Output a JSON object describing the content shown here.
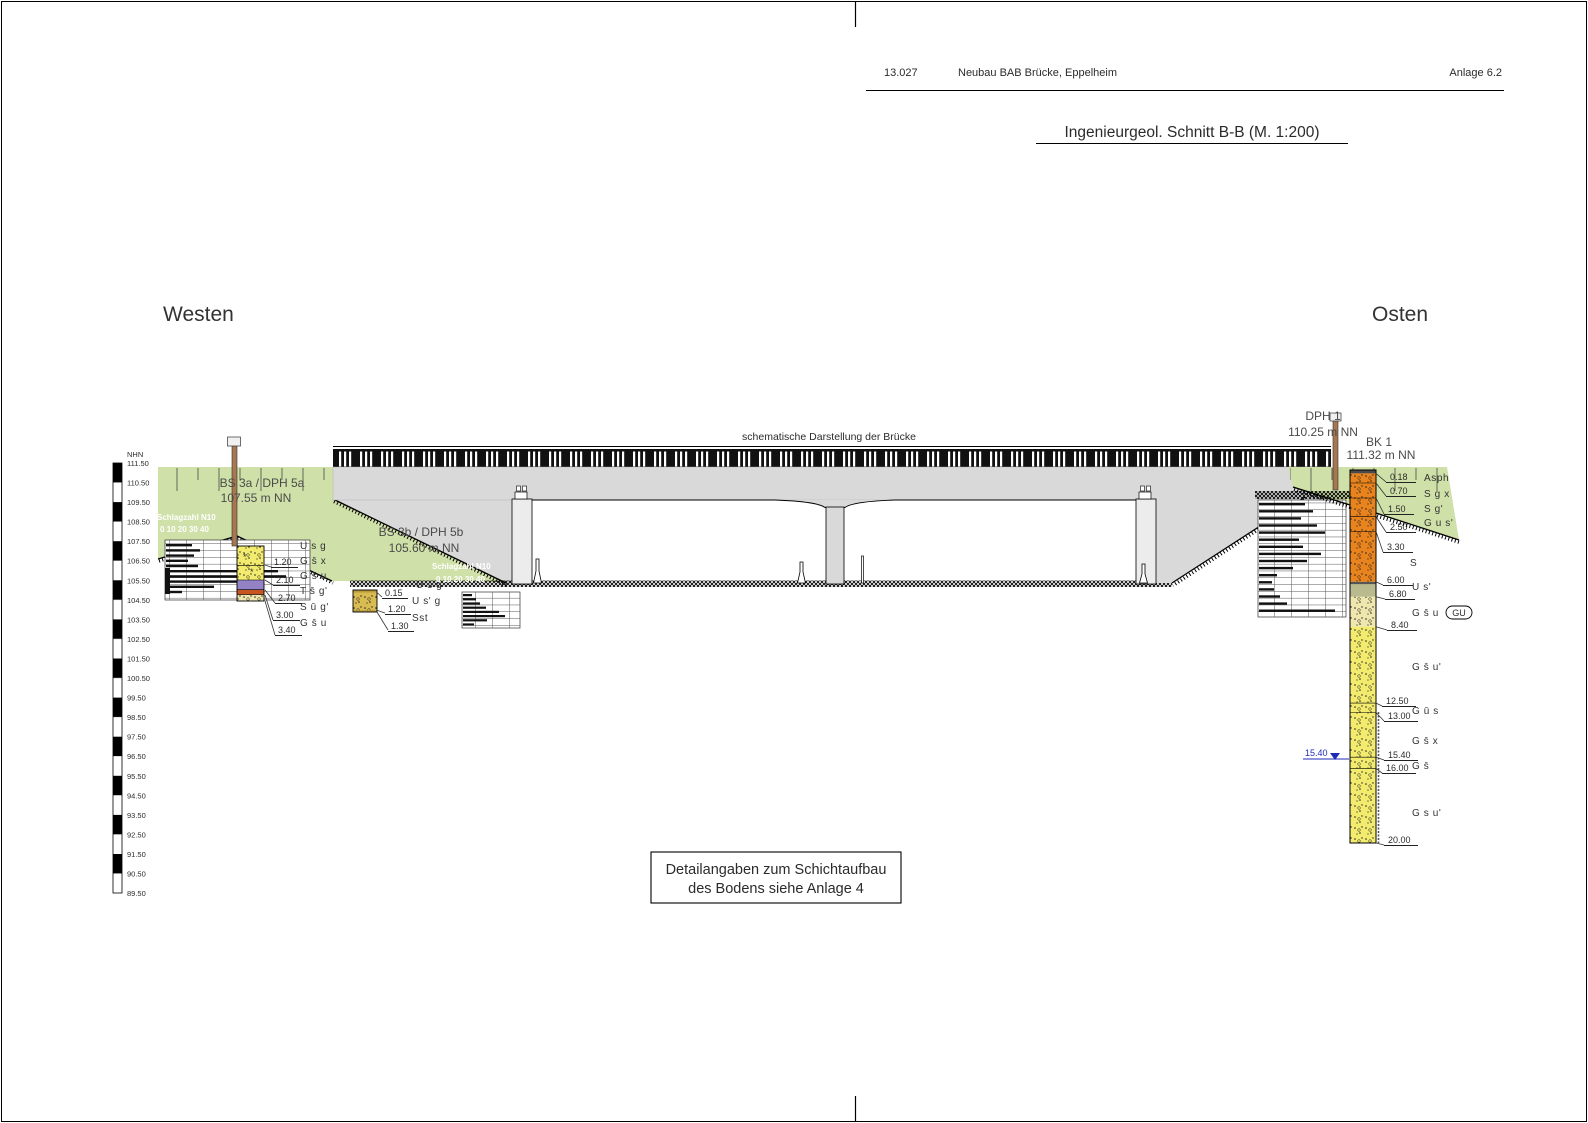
{
  "header": {
    "project_no": "13.027",
    "project_title": "Neubau BAB Brücke, Eppelheim",
    "annex": "Anlage 6.2"
  },
  "title": "Ingenieurgeol. Schnitt B-B (M. 1:200)",
  "orientation": {
    "west": "Westen",
    "east": "Osten"
  },
  "bridge_caption": "schematische Darstellung der Brücke",
  "note": {
    "line1": "Detailangaben zum Schichtaufbau",
    "line2": "des Bodens siehe Anlage 4"
  },
  "elevation_scale": {
    "unit": "NHN",
    "ticks": [
      "111.50",
      "110.50",
      "109.50",
      "108.50",
      "107.50",
      "106.50",
      "105.50",
      "104.50",
      "103.50",
      "102.50",
      "101.50",
      "100.50",
      "99.50",
      "98.50",
      "97.50",
      "96.50",
      "95.50",
      "94.50",
      "93.50",
      "92.50",
      "91.50",
      "90.50",
      "89.50"
    ]
  },
  "dph_axis": {
    "line1": "Schlagzahl N10",
    "line2": "0  10  20  30  40"
  },
  "soundings": {
    "bs3a": {
      "name": "BS 3a / DPH 5a",
      "elevation": "107.55 m NN",
      "depths": [
        "1.20",
        "2.10",
        "2.70",
        "3.00",
        "3.40"
      ],
      "layers": [
        "U s g",
        "G s̄ x",
        "G s̄ u",
        "T s̄ g'",
        "S ū g'",
        "G s̄ u"
      ]
    },
    "bs3b": {
      "name": "BS 3b / DPH 5b",
      "elevation": "105.60 m NN",
      "depths": [
        "0.15",
        "1.20",
        "1.30"
      ],
      "layers": [
        "U s g",
        "U s' g",
        "Sst"
      ]
    },
    "dph1": {
      "name": "DPH 1",
      "elevation": "110.25 m NN"
    },
    "bk1": {
      "name": "BK 1",
      "elevation": "111.32 m NN",
      "depths": [
        "0.18",
        "0.70",
        "1.50",
        "2.50",
        "3.30",
        "6.00",
        "6.80",
        "8.40",
        "12.50",
        "13.00",
        "15.40",
        "16.00",
        "20.00"
      ],
      "layers": [
        "Asph",
        "S g x",
        "S g'",
        "G u s'",
        "S",
        "U s'",
        "G s̄ u",
        "G s̄ u'",
        "G ū s",
        "G s̄ x",
        "G s̄",
        "G s u'"
      ],
      "tag": "GU",
      "water_level": "15.40"
    }
  },
  "colors": {
    "embankment_green": "#cfe0a8",
    "concrete_gray": "#d9d9d9",
    "orange_sand": "#e8831d",
    "yellow_gravel": "#f3eb6e",
    "pale_gravel": "#efe7ad",
    "purple_clay": "#9383c6",
    "red_silt": "#c8541f",
    "olive_silt": "#b9bb8e",
    "tan_fill": "#d8bc52",
    "asphalt": "#4a4a4a",
    "water_blue": "#1f2bb5",
    "rod_brown": "#a8764f"
  }
}
